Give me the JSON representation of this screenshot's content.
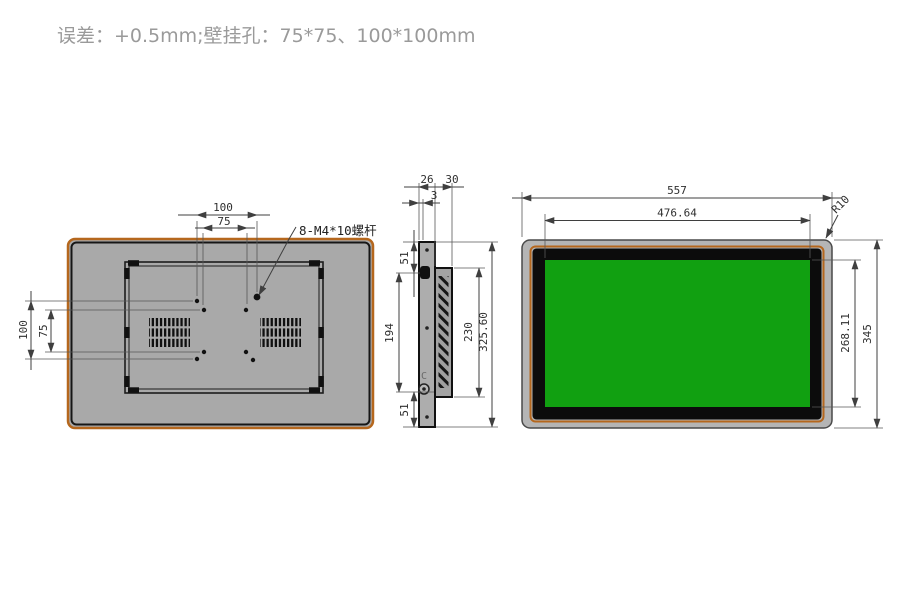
{
  "title": "误差：+0.5mm;壁挂孔：75*75、100*100mm",
  "rear": {
    "hole_pitch_h_outer": "100",
    "hole_pitch_h_inner": "75",
    "hole_pitch_v_outer": "100",
    "hole_pitch_v_inner": "75",
    "screw_label": "8-M4*10螺杆"
  },
  "side": {
    "depth_front": "26",
    "depth_total": "30",
    "panel_thickness": "3",
    "offset_top": "51",
    "span_middle": "194",
    "offset_bottom": "51",
    "body_height": "230",
    "total_height": "325.60",
    "marker": "C"
  },
  "front": {
    "width_total": "557",
    "width_display": "476.64",
    "height_total": "345",
    "height_display": "268.11",
    "corner_radius": "R10"
  },
  "colors": {
    "accent_orange": "#b5671d",
    "screen_green": "#11a011",
    "panel_gray": "#a9a9a9",
    "bezel_gray": "#b5b5b5",
    "line": "#3f3f3f",
    "title_gray": "#9a9a9a"
  }
}
